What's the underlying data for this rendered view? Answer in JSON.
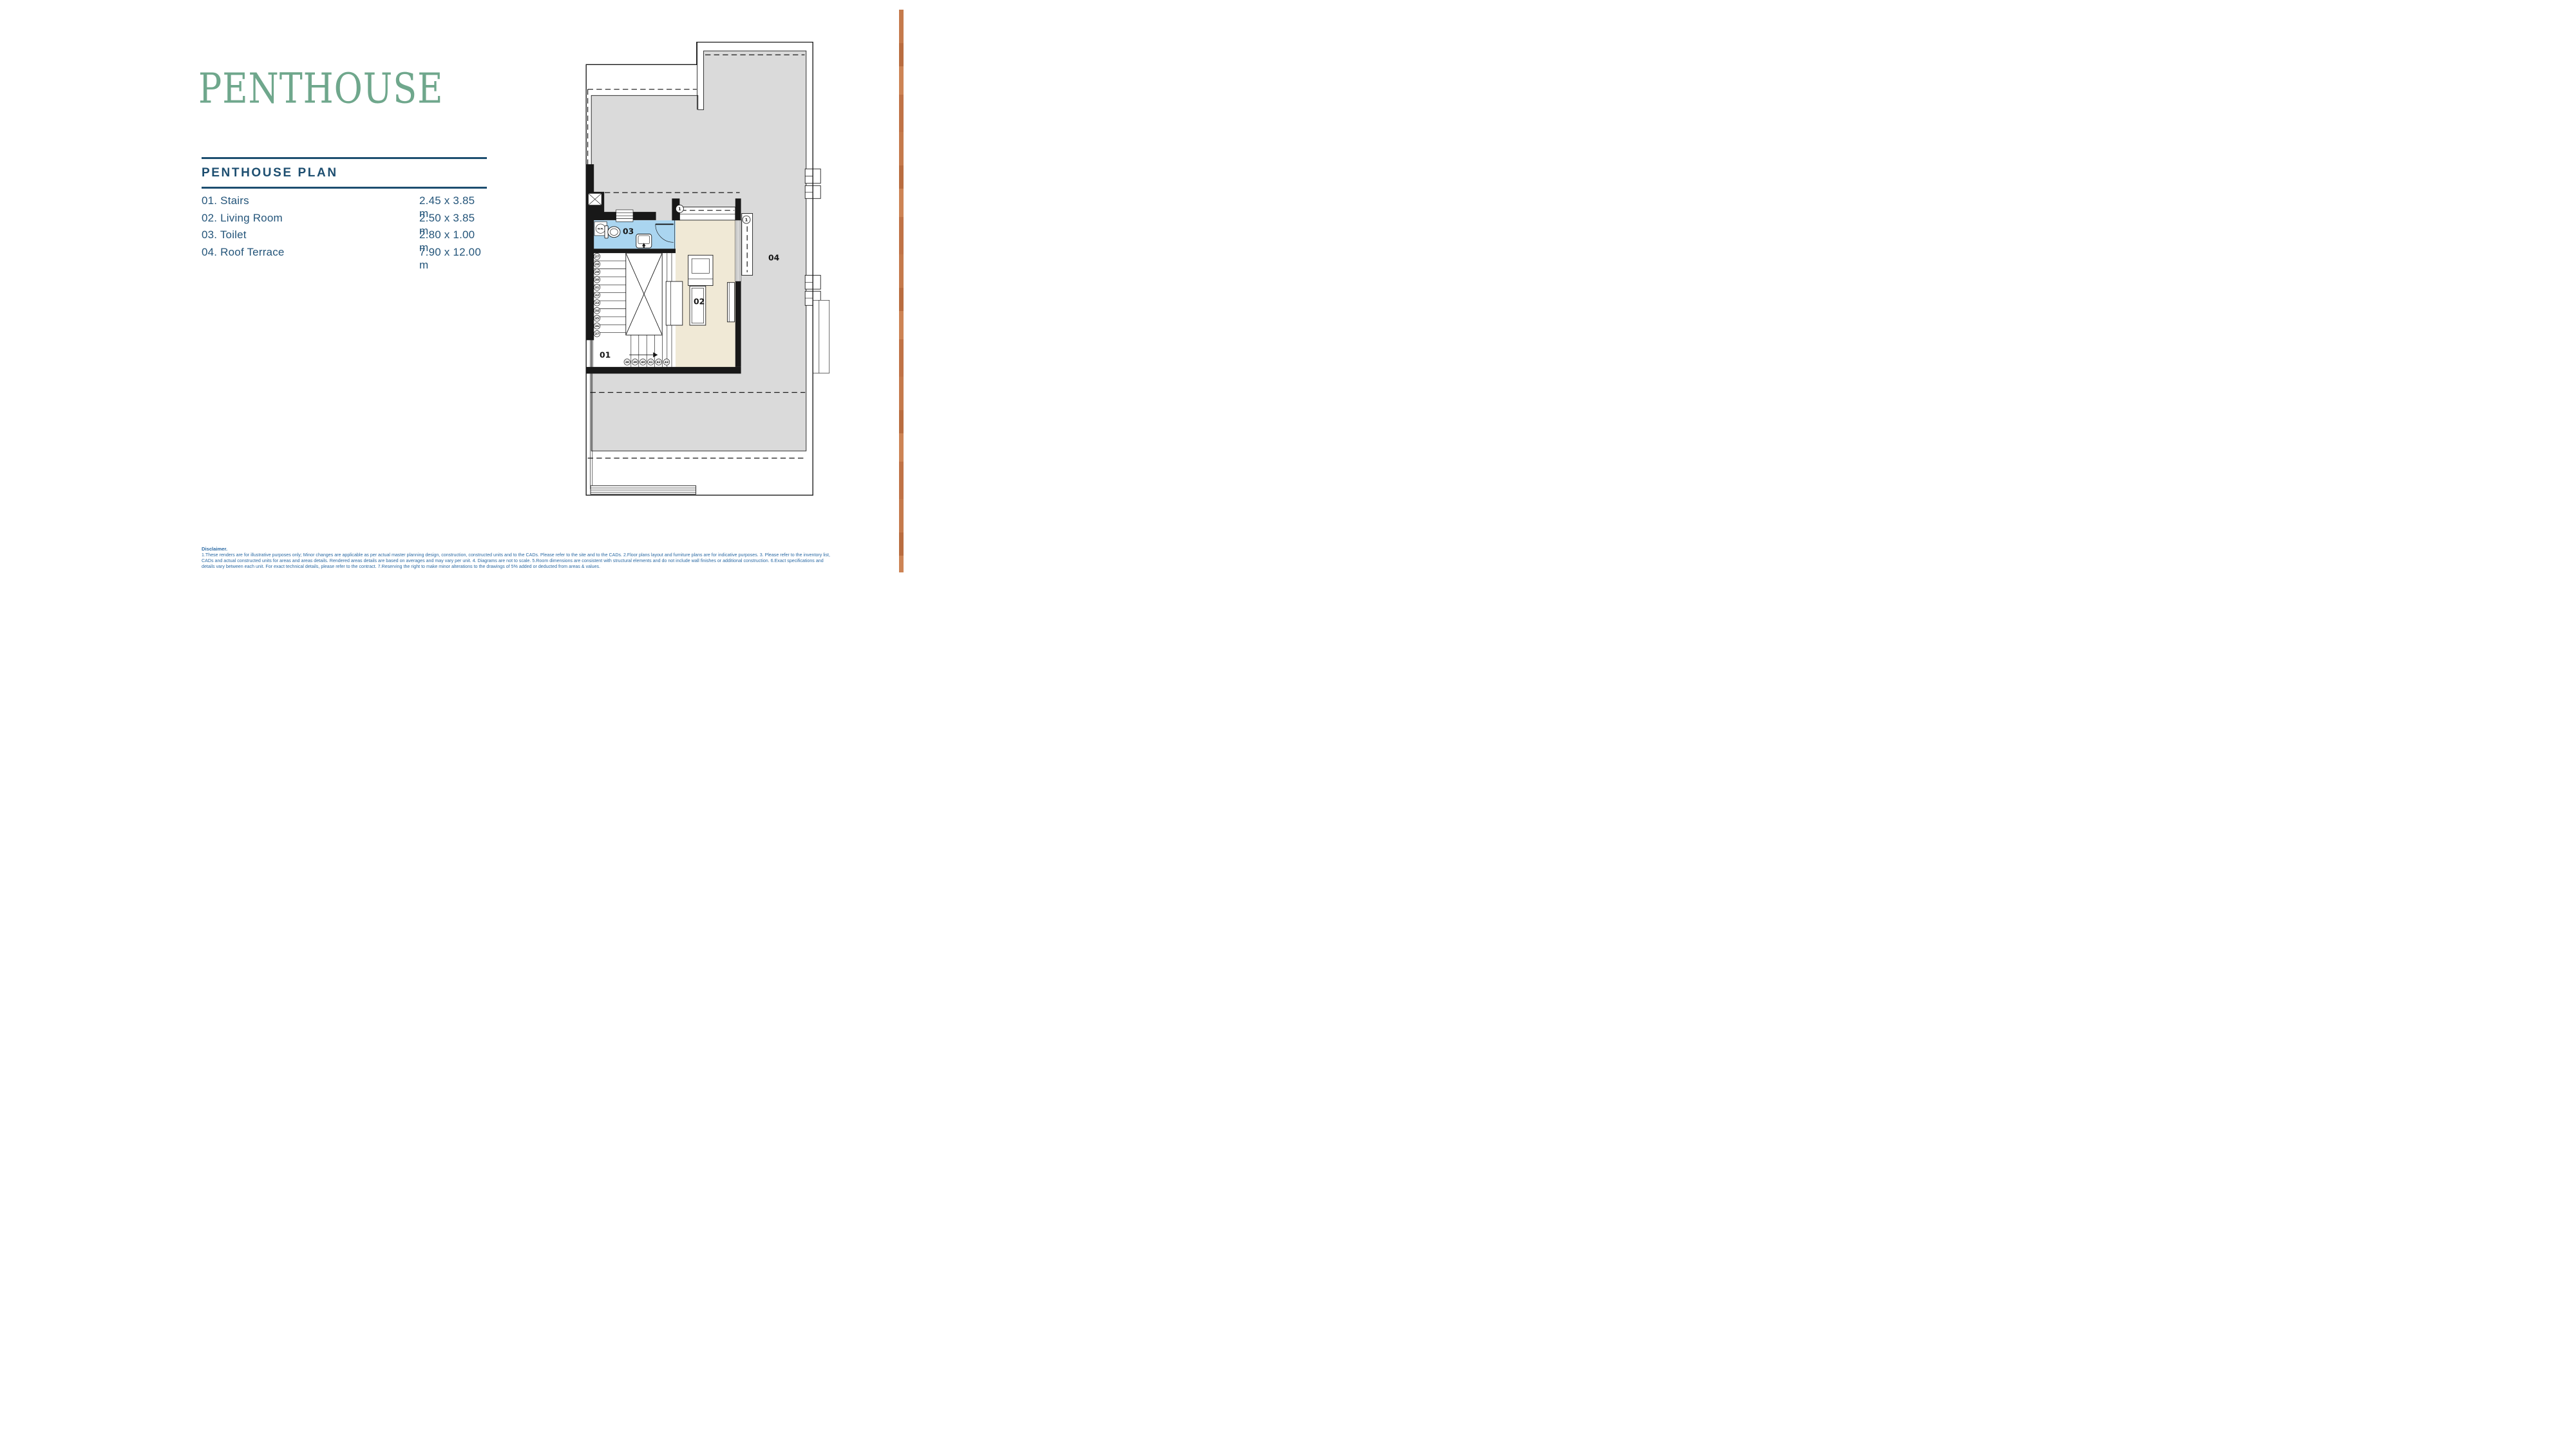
{
  "title": "PENTHOUSE",
  "legend": {
    "header": "PENTHOUSE PLAN",
    "rows": [
      {
        "label": "01. Stairs",
        "dims": "2.45 x 3.85 m"
      },
      {
        "label": "02. Living Room",
        "dims": "2.50 x 3.85 m"
      },
      {
        "label": "03. Toilet",
        "dims": "2.80 x 1.00 m"
      },
      {
        "label": "04. Roof Terrace",
        "dims": "7.90 x 12.00 m"
      }
    ]
  },
  "floor_plan": {
    "room_labels": {
      "stairs": "01",
      "living_room": "02",
      "toilet": "03",
      "roof_terrace": "04"
    },
    "door_marks": [
      "1",
      "1"
    ],
    "washing_machine_label": "W.M.",
    "stair_step_numbers_left": [
      "27",
      "28",
      "29",
      "30",
      "31",
      "32",
      "33",
      "34",
      "35",
      "36",
      "37"
    ],
    "stair_step_numbers_bottom": [
      "38",
      "39",
      "40",
      "41",
      "42",
      "43"
    ]
  },
  "disclaimer": {
    "heading": "Disclaimer.",
    "body": "1.These renders are for illustrative purposes only; Minor changes are applicable as per actual master planning design, construction, constructed units and to the CADs. Please refer to the site and to the CADs.  2.Floor plans layout and furniture plans are for indicative purposes. 3. Please refer to the inventory list, CADs and actual constructed units for areas and areas details. Rendered areas details are based on averages and may vary per unit. 4. Diagrams are not to scale.  5.Room dimensions are consistent with structural elements and do not include wall finishes or additional construction.  6.Exact specifications and details vary between each unit. For exact technical details, please refer to the contract.  7.Reserving the right to make minor alterations to the drawings of 5% added or deducted from areas & values."
  },
  "colors": {
    "title_green": "#6fa78c",
    "navy": "#1d4e70",
    "list_text": "#24557a",
    "disclaimer_blue": "#2b6aa4",
    "terrace_gray": "#dadada",
    "toilet_blue": "#aad5f0",
    "living_cream": "#f0e9d6",
    "line_black": "#181818",
    "stripe_copper": "#c3774a"
  }
}
